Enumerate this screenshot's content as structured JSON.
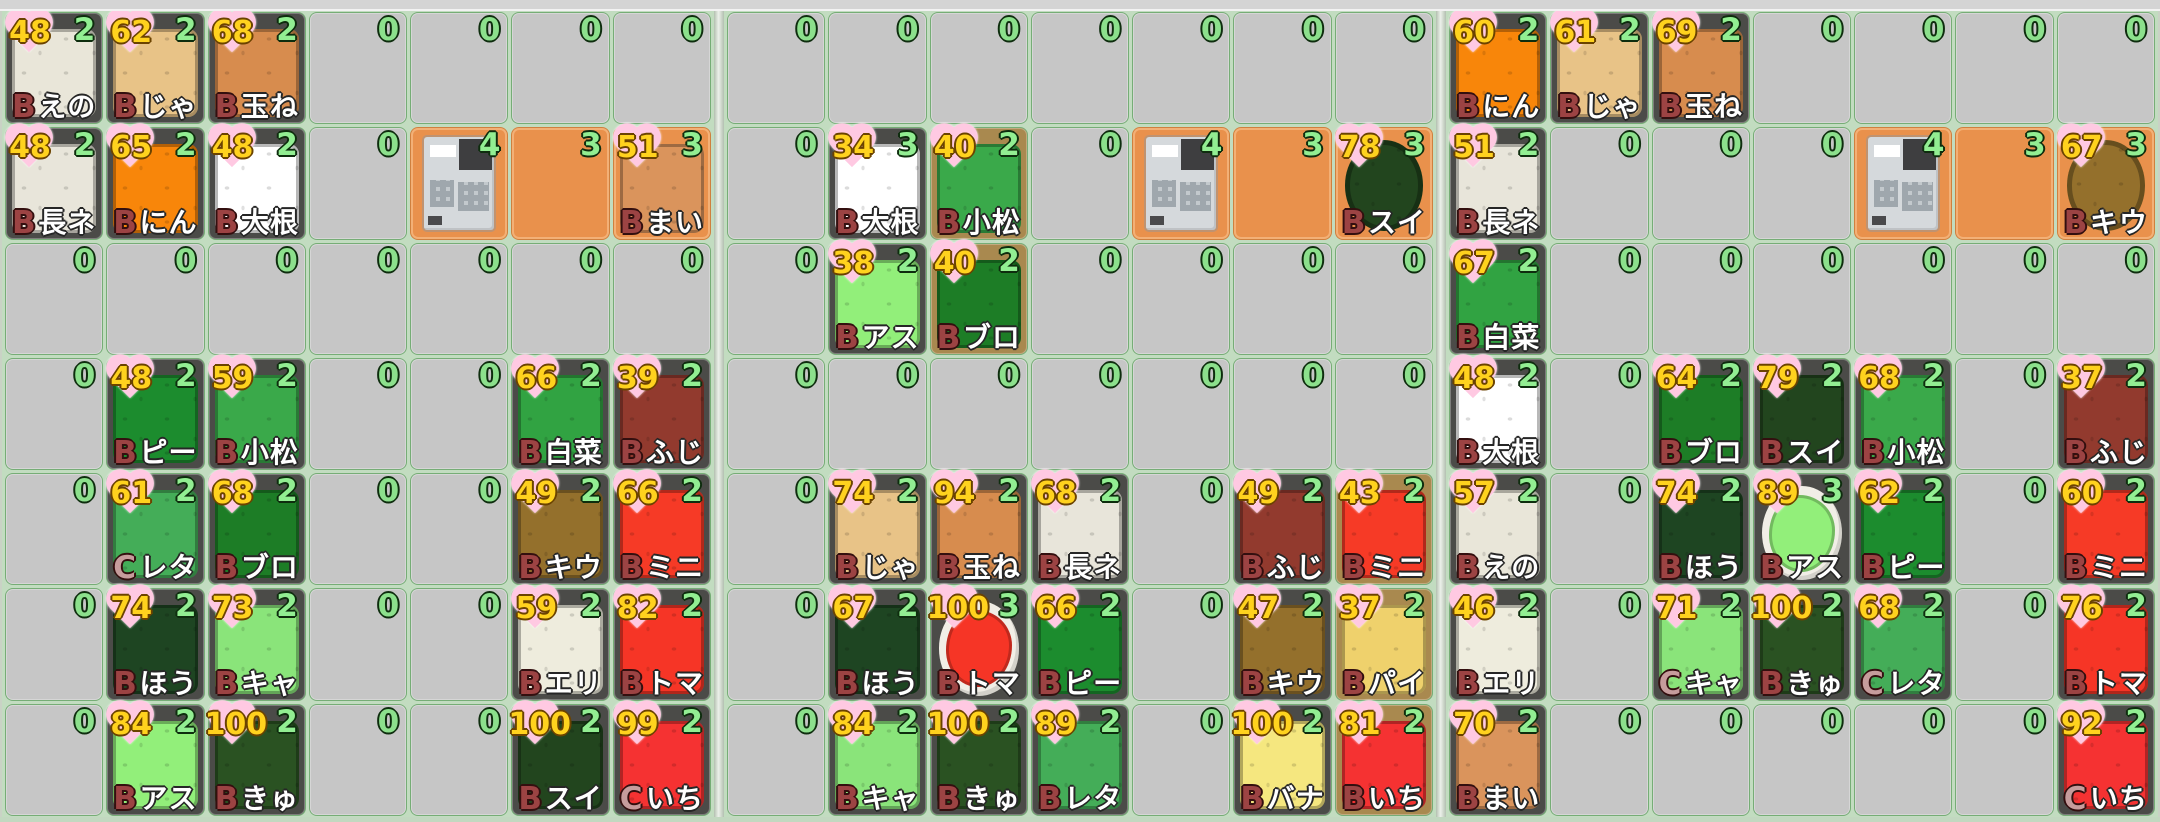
{
  "screen": {
    "kind": "farm-market-grid",
    "panel_count": 3,
    "grid_cols": 7,
    "grid_rows": 7
  },
  "colors": {
    "page_bg": "#c9d2c5",
    "top_strip": "#d4d4d4",
    "bottom_strip": "#c2d8c0",
    "panel_bg": "#c2dcc0",
    "divider": "#ecf1ea",
    "cell_empty": "#c6c6c6",
    "cell_dark": "#4b4b48",
    "cell_soil": "#a9894f",
    "cell_market": "#e9914c",
    "count_green": "#92ee92",
    "price_yellow": "#ffd21e",
    "heart_pink": "#ffc9e2",
    "grade_b": "#9c4343",
    "grade_c": "#c69c9c",
    "name_white": "#ffffff",
    "plate_white": "#f1eee6"
  },
  "crop_colors": {
    "えの": "#e9e6d9",
    "じゃ": "#e8c387",
    "玉ね": "#d78c4e",
    "長ネ": "#e8e5da",
    "にん": "#f8860a",
    "大根": "#ffffff",
    "まい": "#da945c",
    "ピー": "#1c8c2e",
    "小松": "#3aa94a",
    "白菜": "#31a342",
    "ふじ": "#923a2e",
    "レタ": "#44ad58",
    "ブロ": "#1d7d26",
    "キウ": "#94702c",
    "ミニ": "#f63a26",
    "ほう": "#1e4522",
    "キャ": "#8ae47a",
    "エリ": "#eeecdd",
    "トマ": "#f63526",
    "アス": "#92ef7a",
    "きゅ": "#2a5222",
    "スイ": "#22451e",
    "いち": "#f53232",
    "パイ": "#efd16c",
    "バナ": "#f5e77f"
  },
  "panels": [
    {
      "rows": [
        [
          {
            "p": 48,
            "n": 2,
            "g": "B",
            "l": "えの"
          },
          {
            "p": 62,
            "n": 2,
            "g": "B",
            "l": "じゃ"
          },
          {
            "p": 68,
            "n": 2,
            "g": "B",
            "l": "玉ね"
          },
          0,
          0,
          0,
          0
        ],
        [
          {
            "p": 48,
            "n": 2,
            "g": "B",
            "l": "長ネ"
          },
          {
            "p": 65,
            "n": 2,
            "g": "B",
            "l": "にん"
          },
          {
            "p": 48,
            "n": 2,
            "g": "B",
            "l": "大根"
          },
          0,
          {
            "n": 4,
            "bg": "market",
            "reg": true
          },
          {
            "n": 3,
            "bg": "market"
          },
          {
            "p": 51,
            "n": 3,
            "g": "B",
            "l": "まい",
            "bg": "market"
          }
        ],
        [
          0,
          0,
          0,
          0,
          0,
          0,
          0
        ],
        [
          0,
          {
            "p": 48,
            "n": 2,
            "g": "B",
            "l": "ピー"
          },
          {
            "p": 59,
            "n": 2,
            "g": "B",
            "l": "小松"
          },
          0,
          0,
          {
            "p": 66,
            "n": 2,
            "g": "B",
            "l": "白菜"
          },
          {
            "p": 39,
            "n": 2,
            "g": "B",
            "l": "ふじ"
          }
        ],
        [
          0,
          {
            "p": 61,
            "n": 2,
            "g": "C",
            "l": "レタ"
          },
          {
            "p": 68,
            "n": 2,
            "g": "B",
            "l": "ブロ"
          },
          0,
          0,
          {
            "p": 49,
            "n": 2,
            "g": "B",
            "l": "キウ"
          },
          {
            "p": 66,
            "n": 2,
            "g": "B",
            "l": "ミニ"
          }
        ],
        [
          0,
          {
            "p": 74,
            "n": 2,
            "g": "B",
            "l": "ほう"
          },
          {
            "p": 73,
            "n": 2,
            "g": "B",
            "l": "キャ"
          },
          0,
          0,
          {
            "p": 59,
            "n": 2,
            "g": "B",
            "l": "エリ"
          },
          {
            "p": 82,
            "n": 2,
            "g": "B",
            "l": "トマ"
          }
        ],
        [
          0,
          {
            "p": 84,
            "n": 2,
            "g": "B",
            "l": "アス"
          },
          {
            "p": 100,
            "n": 2,
            "g": "B",
            "l": "きゅ"
          },
          0,
          0,
          {
            "p": 100,
            "n": 2,
            "g": "B",
            "l": "スイ"
          },
          {
            "p": 99,
            "n": 2,
            "g": "C",
            "l": "いち"
          }
        ]
      ]
    },
    {
      "rows": [
        [
          0,
          0,
          0,
          0,
          0,
          0,
          0
        ],
        [
          0,
          {
            "p": 34,
            "n": 3,
            "g": "B",
            "l": "大根"
          },
          {
            "p": 40,
            "n": 2,
            "g": "B",
            "l": "小松",
            "bg": "soil"
          },
          0,
          {
            "n": 4,
            "bg": "market",
            "reg": true
          },
          {
            "n": 3,
            "bg": "market"
          },
          {
            "p": 78,
            "n": 3,
            "g": "B",
            "l": "スイ",
            "bg": "market",
            "sh": "circle"
          }
        ],
        [
          0,
          {
            "p": 38,
            "n": 2,
            "g": "B",
            "l": "アス"
          },
          {
            "p": 40,
            "n": 2,
            "g": "B",
            "l": "ブロ",
            "bg": "soil"
          },
          0,
          0,
          0,
          0
        ],
        [
          0,
          0,
          0,
          0,
          0,
          0,
          0
        ],
        [
          0,
          {
            "p": 74,
            "n": 2,
            "g": "B",
            "l": "じゃ"
          },
          {
            "p": 94,
            "n": 2,
            "g": "B",
            "l": "玉ね"
          },
          {
            "p": 68,
            "n": 2,
            "g": "B",
            "l": "長ネ"
          },
          0,
          {
            "p": 49,
            "n": 2,
            "g": "B",
            "l": "ふじ"
          },
          {
            "p": 43,
            "n": 2,
            "g": "B",
            "l": "ミニ",
            "bg": "soil"
          }
        ],
        [
          0,
          {
            "p": 67,
            "n": 2,
            "g": "B",
            "l": "ほう"
          },
          {
            "p": 100,
            "n": 3,
            "g": "B",
            "l": "トマ",
            "sh": "plate"
          },
          {
            "p": 66,
            "n": 2,
            "g": "B",
            "l": "ピー"
          },
          0,
          {
            "p": 47,
            "n": 2,
            "g": "B",
            "l": "キウ"
          },
          {
            "p": 37,
            "n": 2,
            "g": "B",
            "l": "パイ",
            "bg": "soil"
          }
        ],
        [
          0,
          {
            "p": 84,
            "n": 2,
            "g": "B",
            "l": "キャ"
          },
          {
            "p": 100,
            "n": 2,
            "g": "B",
            "l": "きゅ"
          },
          {
            "p": 89,
            "n": 2,
            "g": "B",
            "l": "レタ"
          },
          0,
          {
            "p": 100,
            "n": 2,
            "g": "B",
            "l": "バナ"
          },
          {
            "p": 81,
            "n": 2,
            "g": "B",
            "l": "いち",
            "bg": "soil"
          }
        ]
      ]
    },
    {
      "rows": [
        [
          {
            "p": 60,
            "n": 2,
            "g": "B",
            "l": "にん"
          },
          {
            "p": 61,
            "n": 2,
            "g": "B",
            "l": "じゃ"
          },
          {
            "p": 69,
            "n": 2,
            "g": "B",
            "l": "玉ね"
          },
          0,
          0,
          0,
          0
        ],
        [
          {
            "p": 51,
            "n": 2,
            "g": "B",
            "l": "長ネ"
          },
          0,
          0,
          0,
          {
            "n": 4,
            "bg": "market",
            "reg": true
          },
          {
            "n": 3,
            "bg": "market"
          },
          {
            "p": 67,
            "n": 3,
            "g": "B",
            "l": "キウ",
            "bg": "market",
            "sh": "circle"
          }
        ],
        [
          {
            "p": 67,
            "n": 2,
            "g": "B",
            "l": "白菜"
          },
          0,
          0,
          0,
          0,
          0,
          0
        ],
        [
          {
            "p": 48,
            "n": 2,
            "g": "B",
            "l": "大根"
          },
          0,
          {
            "p": 64,
            "n": 2,
            "g": "B",
            "l": "ブロ"
          },
          {
            "p": 79,
            "n": 2,
            "g": "B",
            "l": "スイ"
          },
          {
            "p": 68,
            "n": 2,
            "g": "B",
            "l": "小松"
          },
          0,
          {
            "p": 37,
            "n": 2,
            "g": "B",
            "l": "ふじ"
          }
        ],
        [
          {
            "p": 57,
            "n": 2,
            "g": "B",
            "l": "えの"
          },
          0,
          {
            "p": 74,
            "n": 2,
            "g": "B",
            "l": "ほう"
          },
          {
            "p": 89,
            "n": 3,
            "g": "B",
            "l": "アス",
            "sh": "plate"
          },
          {
            "p": 62,
            "n": 2,
            "g": "B",
            "l": "ピー"
          },
          0,
          {
            "p": 60,
            "n": 2,
            "g": "B",
            "l": "ミニ"
          }
        ],
        [
          {
            "p": 46,
            "n": 2,
            "g": "B",
            "l": "エリ"
          },
          0,
          {
            "p": 71,
            "n": 2,
            "g": "C",
            "l": "キャ"
          },
          {
            "p": 100,
            "n": 2,
            "g": "B",
            "l": "きゅ"
          },
          {
            "p": 68,
            "n": 2,
            "g": "C",
            "l": "レタ"
          },
          0,
          {
            "p": 76,
            "n": 2,
            "g": "B",
            "l": "トマ"
          }
        ],
        [
          {
            "p": 70,
            "n": 2,
            "g": "B",
            "l": "まい"
          },
          0,
          0,
          0,
          0,
          0,
          {
            "p": 92,
            "n": 2,
            "g": "C",
            "l": "いち"
          }
        ]
      ]
    }
  ]
}
